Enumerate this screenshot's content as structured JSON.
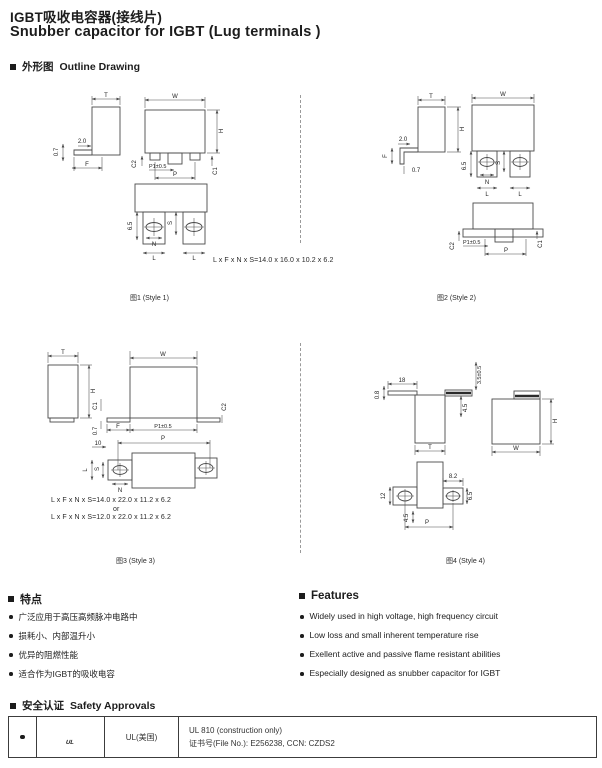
{
  "header": {
    "title_zh": "IGBT吸收电容器(接线片)",
    "title_en": "Snubber capacitor for IGBT (Lug terminals )"
  },
  "outline_section": {
    "title_zh": "外形图",
    "title_en": "Outline Drawing"
  },
  "drawings": {
    "style1": {
      "caption": "图1 (Style 1)",
      "formula": "L x F x N x S=14.0 x 16.0 x 10.2 x 6.2",
      "labels": {
        "T": "T",
        "W": "W",
        "H": "H",
        "F": "F",
        "S": "S",
        "N": "N",
        "L": "L",
        "P": "P",
        "P1": "P1±0.5",
        "C1": "C1",
        "C2": "C2",
        "dim_2_0": "2.0",
        "dim_0_7": "0.7",
        "dim_6_5": "6.5"
      }
    },
    "style2": {
      "caption": "图2 (Style 2)",
      "labels": {
        "T": "T",
        "W": "W",
        "H": "H",
        "F": "F",
        "S": "S",
        "N": "N",
        "L": "L",
        "P": "P",
        "P1": "P1±0.5",
        "C1": "C1",
        "C2": "C2",
        "dim_2_0": "2.0",
        "dim_0_7": "0.7",
        "dim_6_5": "6.5"
      }
    },
    "style3": {
      "caption": "图3 (Style 3)",
      "formula_1": "L x F x N x S=14.0 x 22.0 x 11.2 x 6.2",
      "formula_or": "or",
      "formula_2": "L x F x N x S=12.0 x 22.0 x 11.2 x 6.2",
      "labels": {
        "T": "T",
        "W": "W",
        "H": "H",
        "F": "F",
        "S": "S",
        "N": "N",
        "L": "L",
        "P": "P",
        "P1": "P1±0.5",
        "C1": "C1",
        "C2": "C2",
        "dim_0_7": "0.7",
        "dim_10": "10"
      }
    },
    "style4": {
      "caption": "图4 (Style 4)",
      "labels": {
        "T": "T",
        "W": "W",
        "H": "H",
        "P": "P",
        "dim_18": "18",
        "dim_0_8": "0.8",
        "dim_3_5": "3.5±0.5",
        "dim_4_5": "4.5",
        "dim_8_2": "8.2",
        "dim_12": "12",
        "dim_6_5": "6.5"
      }
    }
  },
  "features_zh": {
    "title": "特点",
    "items": [
      "广泛应用于高压高频脉冲电路中",
      "损耗小、内部温升小",
      "优异的阻燃性能",
      "适合作为IGBT的吸收电容"
    ]
  },
  "features_en": {
    "title": "Features",
    "items": [
      "Widely used in high voltage, high frequency circuit",
      "Low loss and small inherent temperature rise",
      "Exellent active and passive flame resistant abilities",
      "Especially designed as snubber capacitor for IGBT"
    ]
  },
  "safety_section": {
    "title_zh": "安全认证",
    "title_en": "Safety Approvals",
    "table": {
      "logo_text": "UL",
      "org": "UL(美国)",
      "cert_line1": "UL 810 (construction only)",
      "cert_line2": "证书号(File No.): E256238, CCN: CZDS2"
    }
  }
}
